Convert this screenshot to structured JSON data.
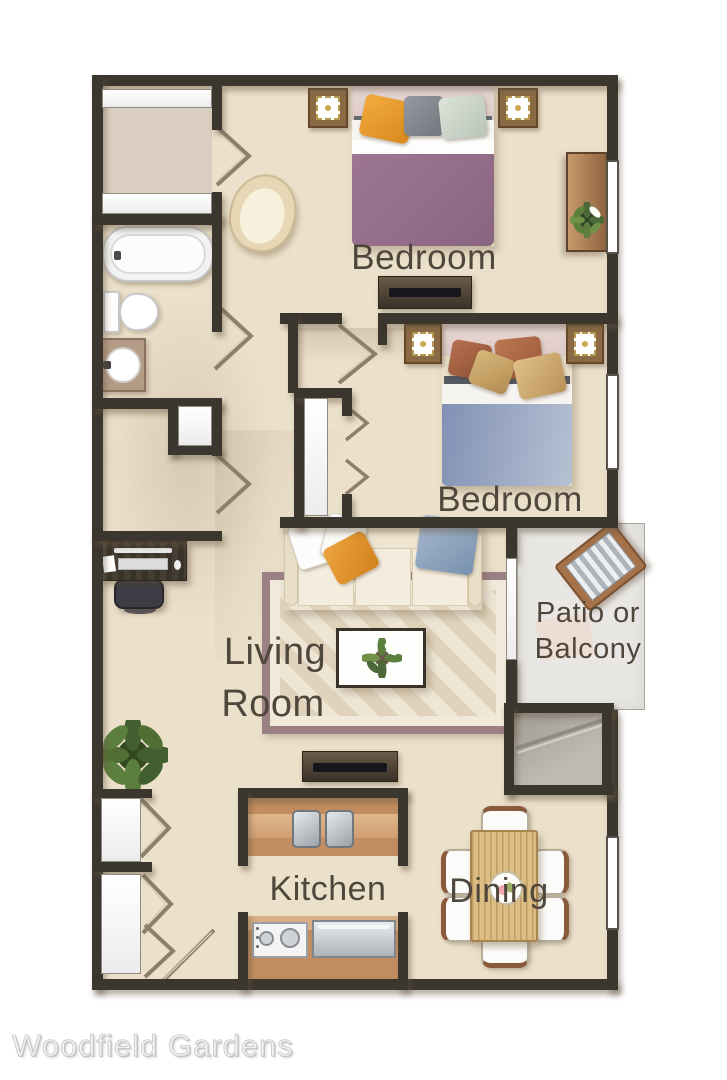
{
  "footer": {
    "title": "Woodfield Gardens"
  },
  "rooms": {
    "bedroom1": {
      "label": "Bedroom"
    },
    "bedroom2": {
      "label": "Bedroom"
    },
    "living": {
      "line1": "Living",
      "line2": "Room"
    },
    "patio": {
      "line1": "Patio or",
      "line2": "Balcony"
    },
    "kitchen": {
      "label": "Kitchen"
    },
    "dining": {
      "label": "Dining"
    }
  },
  "colors": {
    "wall": "#3b362e",
    "floor": "#ebe0ca",
    "label_text": "#4f463c",
    "patio_floor": "#e9e7e4",
    "rug_border": "#9b8084",
    "bed1_blanket": "#96718b",
    "bed2_blanket": "#8c9cbd",
    "pillow_orange": "#e59a31",
    "counter_wood": "#c08c5e",
    "dining_table_wood": "#debf86",
    "title_text": "#f2f2f2"
  }
}
